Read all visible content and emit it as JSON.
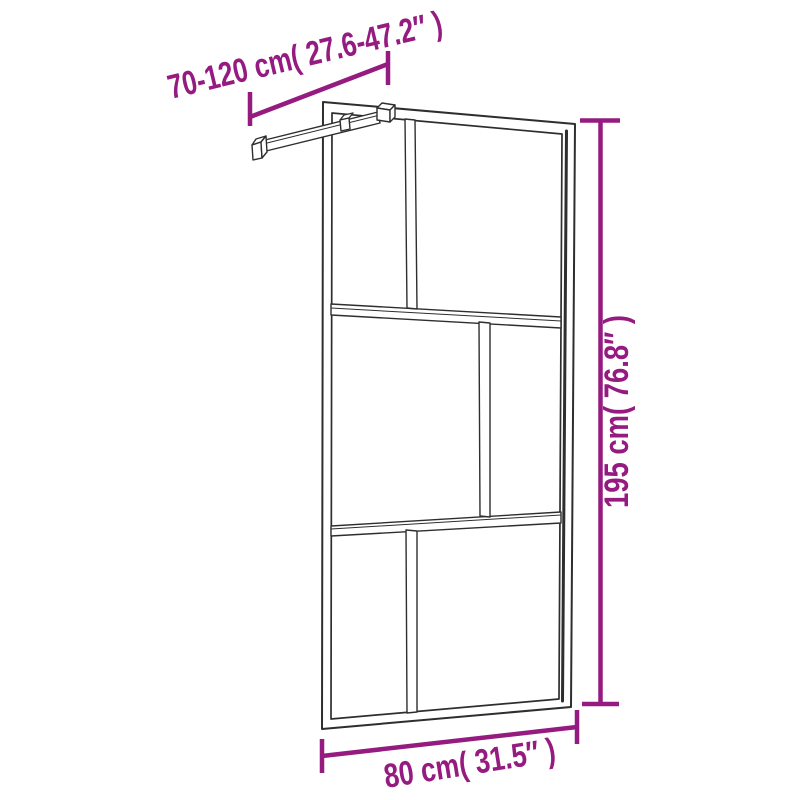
{
  "page": {
    "background": "#ffffff"
  },
  "colors": {
    "dimension": "#951b81",
    "line_art": "#2e2e2e",
    "background": "#ffffff"
  },
  "diagram": {
    "kind": "product-dimension-line-drawing",
    "subject": "walk-in shower glass wall with adjustable support bar",
    "dimensions": {
      "top": {
        "label": "70-120 cm( 27.6-47.2″ )",
        "cm": "70-120",
        "inch": "27.6-47.2"
      },
      "right": {
        "label": "195 cm( 76.8″ )",
        "cm": "195",
        "inch": "76.8"
      },
      "bottom": {
        "label": "80 cm( 31.5″ )",
        "cm": "80",
        "inch": "31.5"
      }
    }
  }
}
